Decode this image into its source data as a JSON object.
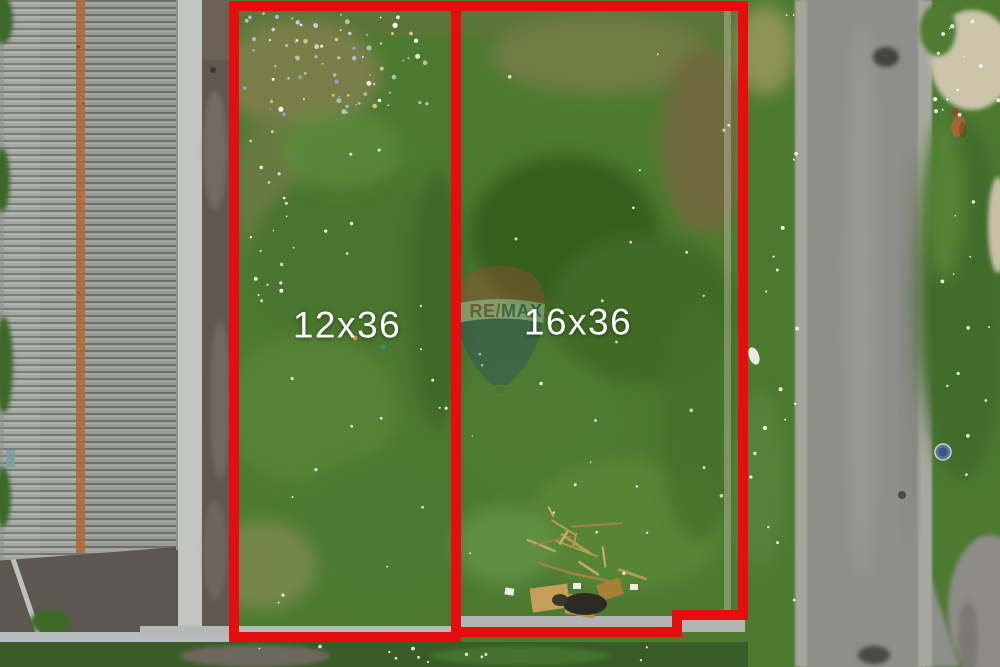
{
  "plots": [
    {
      "label": "12x36"
    },
    {
      "label": "16x36"
    }
  ],
  "watermark": {
    "brand": "RE/MAX",
    "brand_left": "RE/",
    "brand_right": "MAX"
  },
  "colors": {
    "plot_outline": "#e60d0f",
    "plot_label": "#ffffff",
    "balloon_top": "#b5443a",
    "balloon_band": "#efeee6",
    "balloon_bottom": "#20406e",
    "brand_left": "#9e372e",
    "brand_right": "#2a4a80"
  }
}
